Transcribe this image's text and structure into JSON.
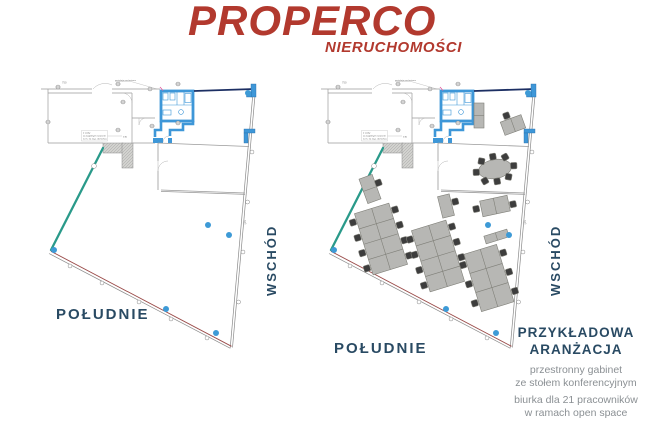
{
  "brand": {
    "name": "PROPERCO",
    "subtitle": "NIERUCHOMOŚCI"
  },
  "compass_labels": {
    "south_left": "POŁUDNIE",
    "east_left": "WSCHÓD",
    "south_right": "POŁUDNIE",
    "east_right": "WSCHÓD"
  },
  "arrangement_note": {
    "heading_line1": "PRZYKŁADOWA",
    "heading_line2": "ARANŻACJA",
    "description": [
      "przestronny gabinet",
      "ze stołem konferencyjnym",
      "biurka dla 21 pracowników",
      "w ramach open space"
    ]
  },
  "plan_annotations": {
    "wardrobe_note_line1": "2 szafy",
    "wardrobe_note_line2": "za wspólnym ścianem",
    "wardrobe_note_line3": "w m. na wys. do końca",
    "dim_wardrobe": "130",
    "dim_top": "750",
    "dim_right_wall": "343",
    "duct_note": "wentylacja mechaniczna"
  },
  "colors": {
    "brand_red": "#b2392e",
    "navy_text": "#294a63",
    "teal_wall": "#2a9a8a",
    "wall_blue": "#3e97d8",
    "dot_blue": "#3d9ad6",
    "window_red": "#9a4a48",
    "desc_gray": "#8b9094"
  }
}
